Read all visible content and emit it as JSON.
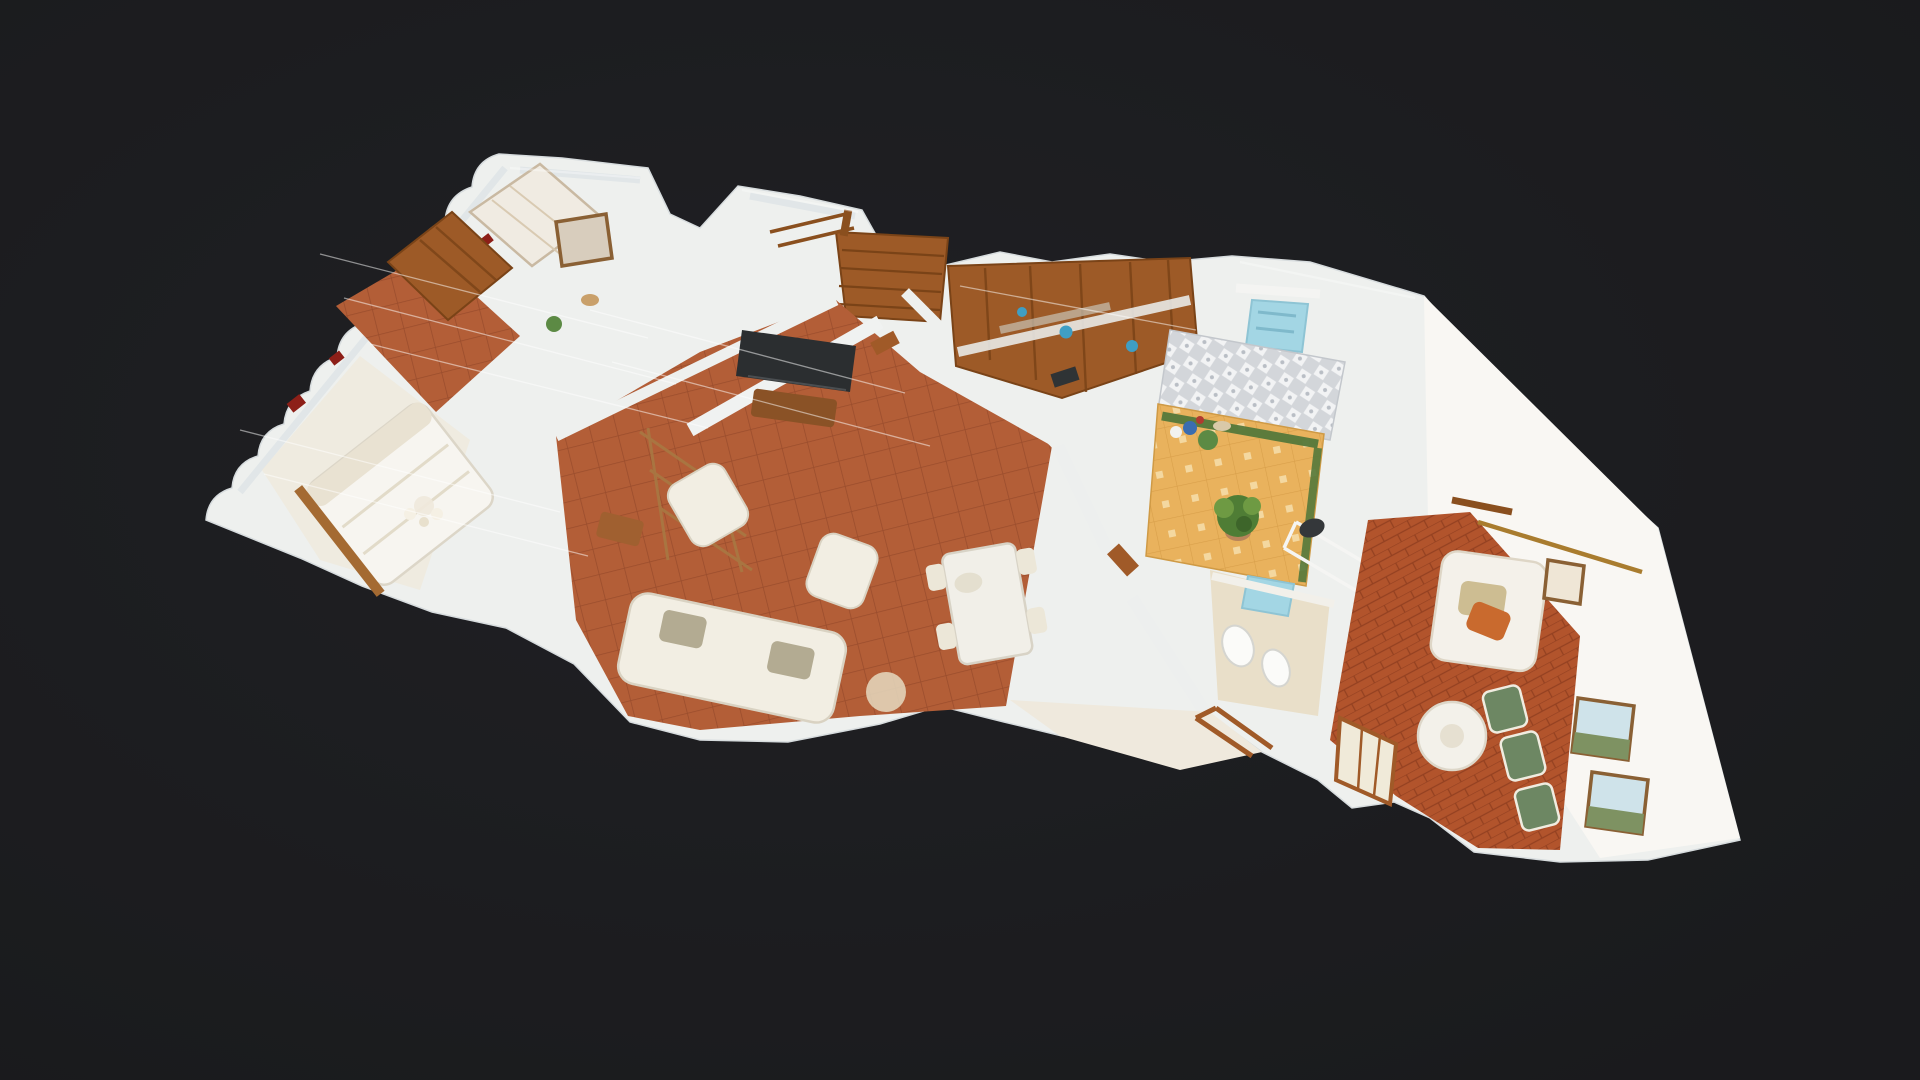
{
  "meta": {
    "app": "3d-property-tour-viewer",
    "view": "dollhouse-cutaway",
    "description": "Top-down angled 3D photogrammetry dollhouse scan of a single-storey apartment floating on a dark canvas"
  },
  "canvas": {
    "width": 1920,
    "height": 1080,
    "background": "#1d1e20",
    "background_center": "#222327",
    "background_edge": "#191a1c"
  },
  "palette": {
    "wall_cut": "#eef0ee",
    "wall_shade": "#dde3e6",
    "wall_bright": "#f9f7f3",
    "floor_terracotta": "#b0572f",
    "floor_terracotta_line": "#8e3f20",
    "floor_brick": "#b2542c",
    "floor_beige": "#e9dfc9",
    "courtyard_tile": "#e9b25d",
    "courtyard_dot": "#f6dda8",
    "courtyard_pattern": "#d3d6da",
    "turf_green": "#55793b",
    "wood": "#9d5a27",
    "wood_dark": "#7a4317",
    "wood_light": "#c07a36",
    "sofa_cream": "#f2eee3",
    "cushion_olive": "#b3ab92",
    "chair_green": "#6d8763",
    "accent_blue": "#a3d6e4",
    "kitchen_blue": "#3f9ec4",
    "accent_orange": "#c96a2e",
    "tv_dark": "#2b2e30",
    "frame_wood": "#8a6034",
    "art_sky": "#cfe3ea",
    "art_land": "#7e9262",
    "brass": "#a97c2e",
    "seam_white": "#ffffff",
    "red_accent": "#8d1f18",
    "plant_green": "#4f7d35",
    "plant_light": "#6e9a43"
  },
  "scene": {
    "type": "residential-interior-scan",
    "rooms": [
      {
        "id": "bedroom-left",
        "label": "bedroom with white bed"
      },
      {
        "id": "bedroom-top-left",
        "label": "bedroom with wardrobe and hallway"
      },
      {
        "id": "stair-room",
        "label": "wooden staircase landing"
      },
      {
        "id": "living-room",
        "label": "living room with TV and cream sofas"
      },
      {
        "id": "dining-area",
        "label": "dining area with white table"
      },
      {
        "id": "kitchen",
        "label": "kitchen with wood cabinets"
      },
      {
        "id": "courtyard",
        "label": "tiled courtyard with plant"
      },
      {
        "id": "bathroom-top",
        "label": "bathroom with blue fixtures"
      },
      {
        "id": "bathroom-right",
        "label": "bathroom with toilet and bidet"
      },
      {
        "id": "right-lounge",
        "label": "lounge with white sofa, green chairs, round table and framed art"
      }
    ]
  }
}
